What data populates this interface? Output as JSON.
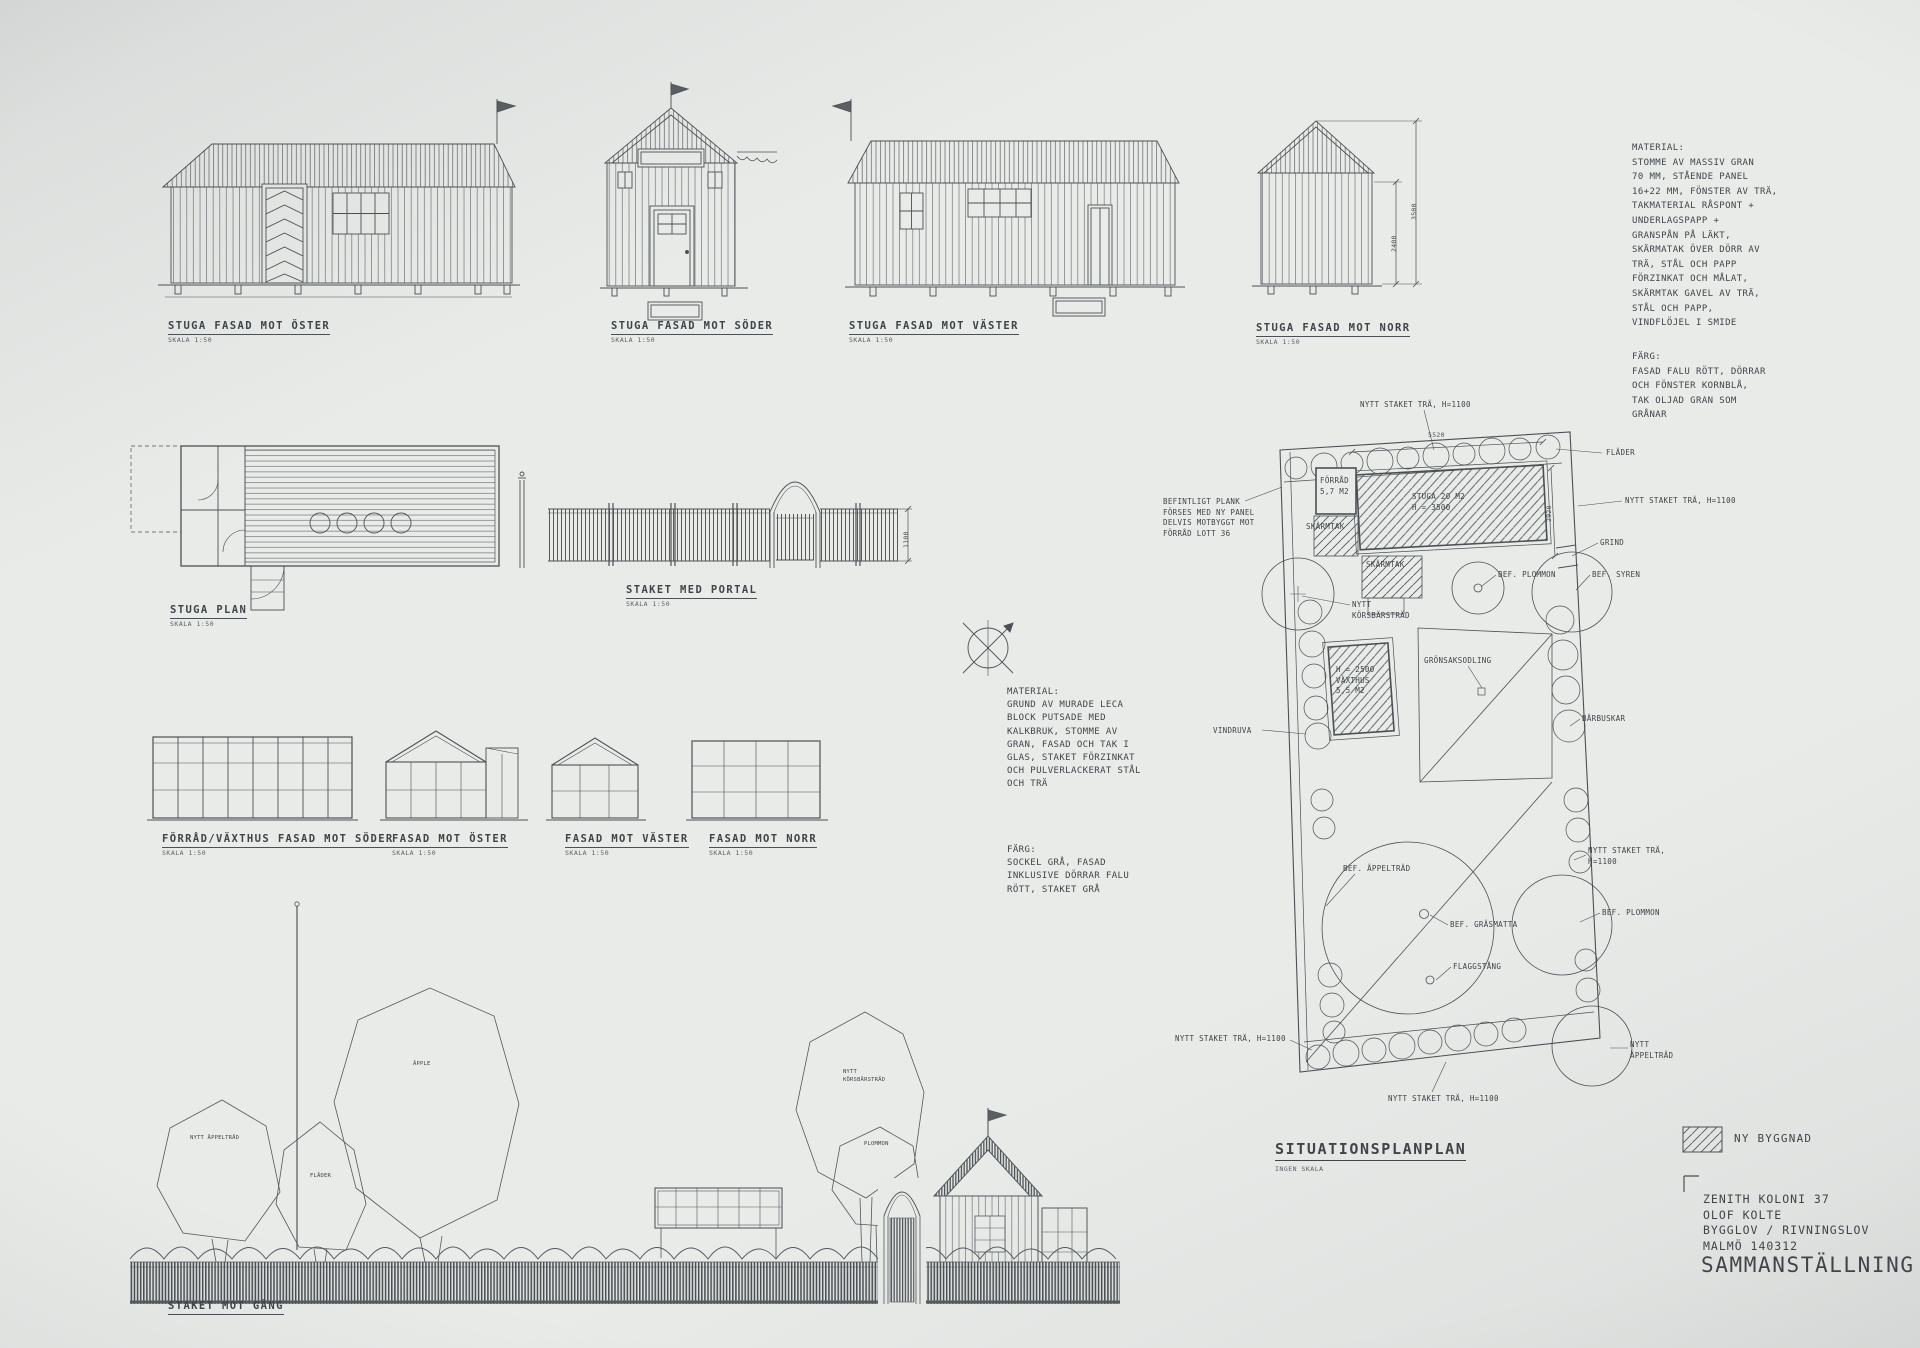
{
  "colors": {
    "paper": "#e9ebe9",
    "ink": "#4b5054"
  },
  "stuga_elevations": {
    "east": {
      "title": "STUGA FASAD MOT ÖSTER",
      "scale": "SKALA 1:50"
    },
    "south": {
      "title": "STUGA FASAD MOT SÖDER",
      "scale": "SKALA 1:50"
    },
    "west": {
      "title": "STUGA FASAD MOT VÄSTER",
      "scale": "SKALA 1:50"
    },
    "north": {
      "title": "STUGA FASAD MOT NORR",
      "scale": "SKALA 1:50"
    },
    "dims": {
      "wall": "2400",
      "ridge": "3500"
    }
  },
  "stuga_notes": {
    "material": "MATERIAL:\nSTOMME AV MASSIV GRAN\n70 MM, STÅENDE PANEL\n16+22 MM, FÖNSTER AV TRÄ,\nTAKMATERIAL RÅSPONT +\nUNDERLAGSPAPP +\nGRANSPÅN PÅ LÄKT,\nSKÄRMATAK ÖVER DÖRR AV\nTRÄ, STÅL OCH PAPP\nFÖRZINKAT OCH MÅLAT,\nSKÄRMTAK GAVEL AV TRÄ,\nSTÅL OCH PAPP,\nVINDFLÖJEL I SMIDE",
    "farg": "FÄRG:\nFASAD FALU RÖTT, DÖRRAR\nOCH FÖNSTER KORNBLÅ,\nTAK OLJAD GRAN SOM\nGRÅNAR"
  },
  "stuga_plan": {
    "title": "STUGA PLAN",
    "scale": "SKALA 1:50"
  },
  "staket_portal": {
    "title": "STAKET MED PORTAL",
    "scale": "SKALA 1:50",
    "height_dim": "1100"
  },
  "vaxthus_elevations": {
    "south": {
      "title": "FÖRRÅD/VÄXTHUS FASAD MOT SÖDER",
      "scale": "SKALA 1:50"
    },
    "east": {
      "title": "FASAD MOT ÖSTER",
      "scale": "SKALA 1:50"
    },
    "west": {
      "title": "FASAD MOT VÄSTER",
      "scale": "SKALA 1:50"
    },
    "north": {
      "title": "FASAD MOT NORR",
      "scale": "SKALA 1:50"
    }
  },
  "vaxthus_notes": {
    "material": "MATERIAL:\nGRUND AV MURADE LECA\nBLOCK PUTSADE MED\nKALKBRUK, STOMME AV\nGRAN, FASAD OCH TAK I\nGLAS, STAKET FÖRZINKAT\nOCH PULVERLACKERAT STÅL\nOCH TRÄ",
    "farg": "FÄRG:\nSOCKEL GRÅ, FASAD\nINKLUSIVE DÖRRAR FALU\nRÖTT, STAKET GRÅ"
  },
  "staket_gang": {
    "title": "STAKET MOT GÅNG"
  },
  "scene_labels": {
    "apple_big": "ÄPPLE",
    "apple_new": "NYTT ÄPPELTRÄD",
    "flader": "FLÄDER",
    "korsbarstrad": "NYTT\nKÖRSBÄRSTRÄD",
    "plommon": "PLOMMON"
  },
  "siteplan": {
    "title": "SITUATIONSPLANPLAN",
    "scale": "INGEN SKALA",
    "labels": {
      "staket_top": "NYTT STAKET TRÄ, H=1100",
      "staket_right": "NYTT STAKET TRÄ, H=1100",
      "staket_right2": "NYTT STAKET TRÄ,\nH=1100",
      "staket_bottom": "NYTT STAKET TRÄ, H=1100",
      "staket_bottom_left": "NYTT STAKET TRÄ, H=1100",
      "flader": "FLÄDER",
      "grind": "GRIND",
      "bef_plommon_top": "BEF. PLOMMON",
      "bef_syren": "BEF. SYREN",
      "befintligt_plank": "BEFINTLIGT PLANK\nFÖRSES MED NY PANEL\nDELVIS MOTBYGGT MOT\nFÖRRÅD LOTT 36",
      "forrad": "FÖRRÅD\n5,7 M2",
      "skarmtak1": "SKÄRMTAK",
      "skarmtak2": "SKÄRMTAK",
      "stuga": "STUGA 20 M2\nH = 3500",
      "korsbarstrad": "NYTT\nKÖRSBÄRSTRÄD",
      "vaxthus": "H = 2500\nVÄXTHUS\n5,5 M2",
      "gronsaksodling": "GRÖNSAKSODLING",
      "vindruva": "VINDRUVA",
      "barbuskar": "BÄRBUSKAR",
      "bef_appeltrad": "BEF. ÄPPELTRÄD",
      "bef_grasmatta": "BEF. GRÄSMATTA",
      "flaggstang": "FLAGGSTÅNG",
      "bef_plommon_low": "BEF. PLOMMON",
      "nytt_appeltrad": "NYTT\nÄPPELTRÄD",
      "dim_top": "5520",
      "dim_right": "2920"
    }
  },
  "legend": {
    "new_building": "NY BYGGNAD"
  },
  "titleblock": {
    "project": "ZENITH KOLONI 37\nOLOF KOLTE\nBYGGLOV / RIVNINGSLOV\nMALMÖ 140312",
    "title": "SAMMANSTÄLLNING"
  }
}
